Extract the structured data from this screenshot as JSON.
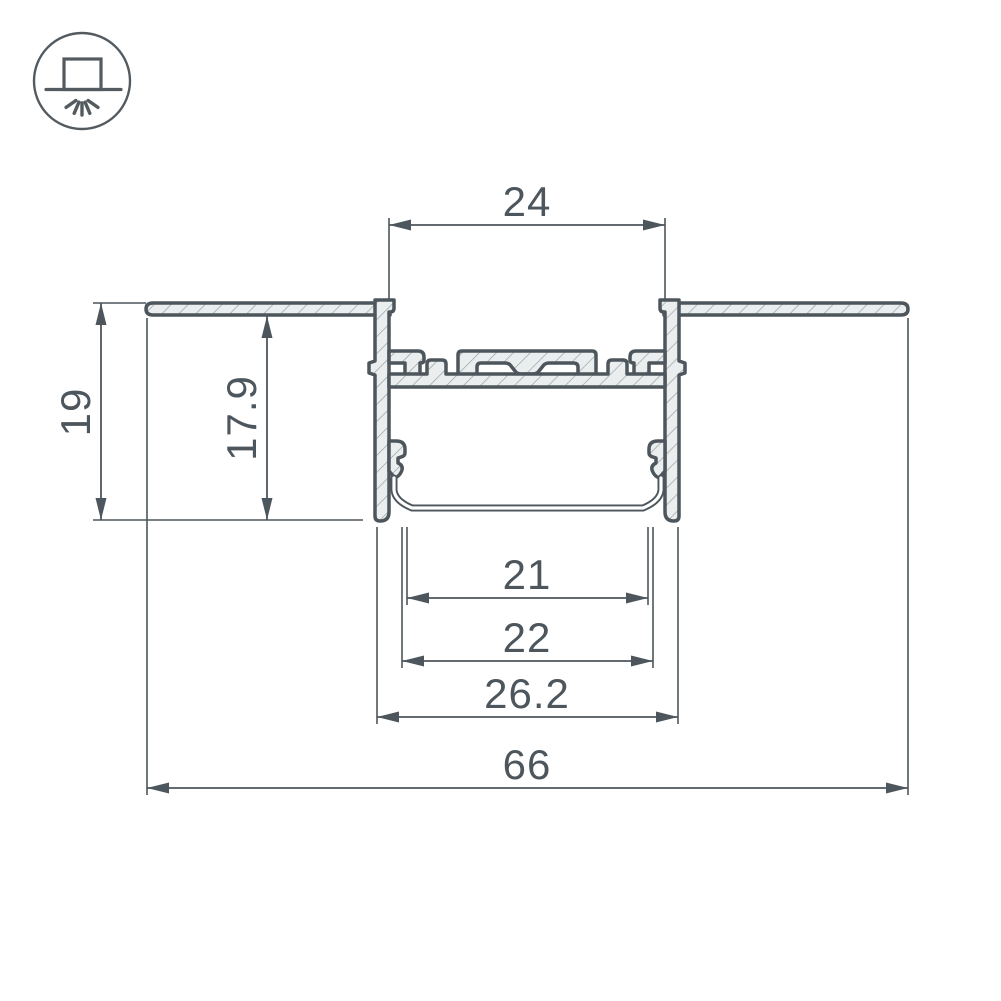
{
  "icon": {
    "name": "recessed-mount-icon",
    "description": "recessed luminaire in ceiling with light rays shining down"
  },
  "colors": {
    "line": "#4d565c",
    "hatch_line": "#99a2a7",
    "hatch_fill": "#ebeeee",
    "background": "#ffffff"
  },
  "dims": {
    "opening": "24",
    "height": "19",
    "inner_height": "17.9",
    "inner_width": "21",
    "diffuser_width": "22",
    "body_width": "26.2",
    "overall": "66"
  }
}
